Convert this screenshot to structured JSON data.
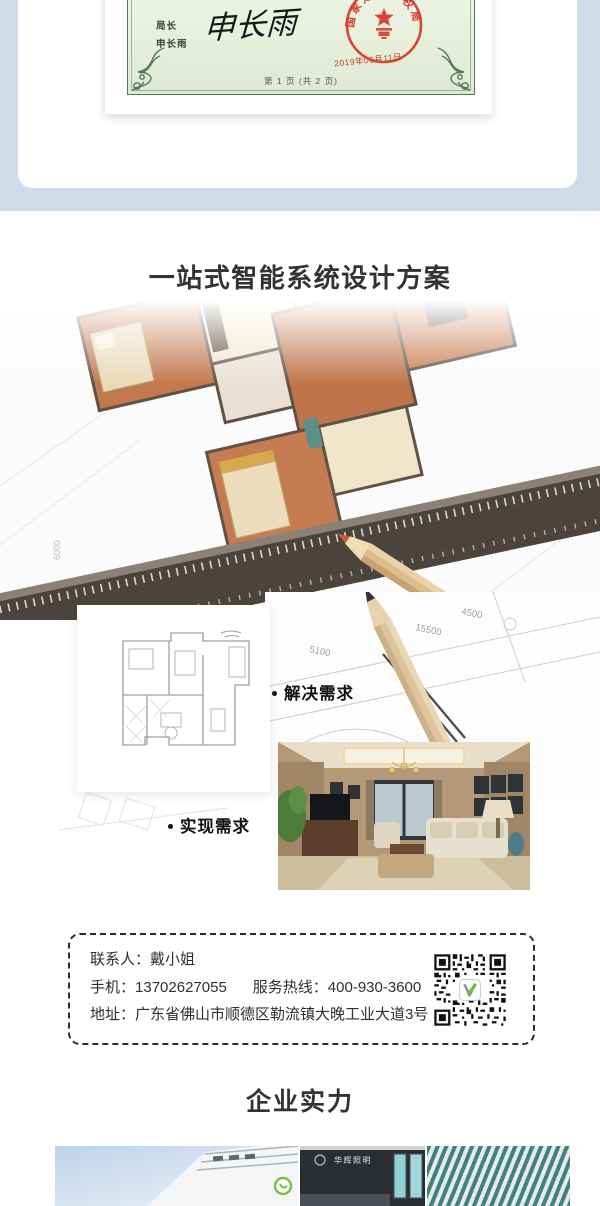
{
  "certificate": {
    "director_label": "局长",
    "director_name": "申长雨",
    "signature": "申长雨",
    "seal_text": "国家知识产权局",
    "seal_date": "2019年06月11日",
    "page_info": "第 1 页 (共 2 页)"
  },
  "solution": {
    "title": "一站式智能系统设计方案",
    "subtitle": "解决装饰布局问题，个性化风格定制",
    "step1": "解决需求",
    "step2": "实现需求",
    "dims": {
      "d1": "5100",
      "d2": "4500",
      "d3": "15500",
      "d4": "6000"
    }
  },
  "contact": {
    "person_label": "联系人：",
    "person_value": "戴小姐",
    "mobile_label": "手机：",
    "mobile_value": "13702627055",
    "hotline_label": "服务热线：",
    "hotline_value": "400-930-3600",
    "address_label": "地址：",
    "address_value": "广东省佛山市顺德区勒流镇大晚工业大道3号"
  },
  "strength": {
    "title": "企业实力",
    "storefront_sign": "华辉照明"
  },
  "colors": {
    "hero_background": "#d1dcea",
    "seal_red": "#d43a2b",
    "certificate_green": "#4f7a58",
    "qr_logo_green": "#6abf3a",
    "title_dark": "#333333",
    "subtitle_gray": "#666666"
  }
}
